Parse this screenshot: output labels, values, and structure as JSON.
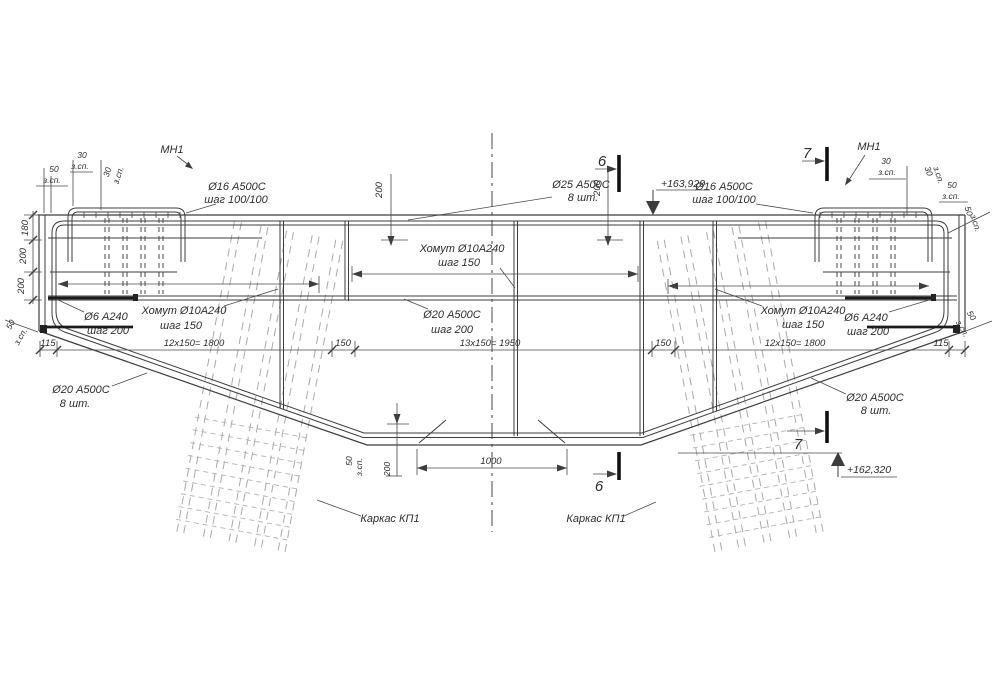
{
  "drawing": {
    "callouts": {
      "mn1": "МН1",
      "d16": [
        "Ø16 А500С",
        "шаг 100/100"
      ],
      "d25": [
        "Ø25 А500С",
        "8 шт."
      ],
      "homut": [
        "Хомут Ø10А240",
        "шаг 150"
      ],
      "d6": [
        "Ø6 А240",
        "шаг 200"
      ],
      "d20_step": [
        "Ø20 А500С",
        "шаг 200"
      ],
      "d20_qty": [
        "Ø20 А500С",
        "8 шт."
      ],
      "karkas": "Каркас КП1"
    },
    "levels": {
      "top": "+163,920",
      "bottom": "+162,320"
    },
    "sections": {
      "s6": "6",
      "s7": "7"
    },
    "dims": {
      "row": [
        "115",
        "12x150= 1800",
        "150",
        "13x150= 1950",
        "150",
        "12x150= 1800",
        "115"
      ],
      "left_col": [
        "180",
        "200",
        "200"
      ],
      "width_1000": "1000",
      "v200": "200",
      "c50": "50",
      "c30": "30",
      "zsp": "з.сп."
    }
  }
}
